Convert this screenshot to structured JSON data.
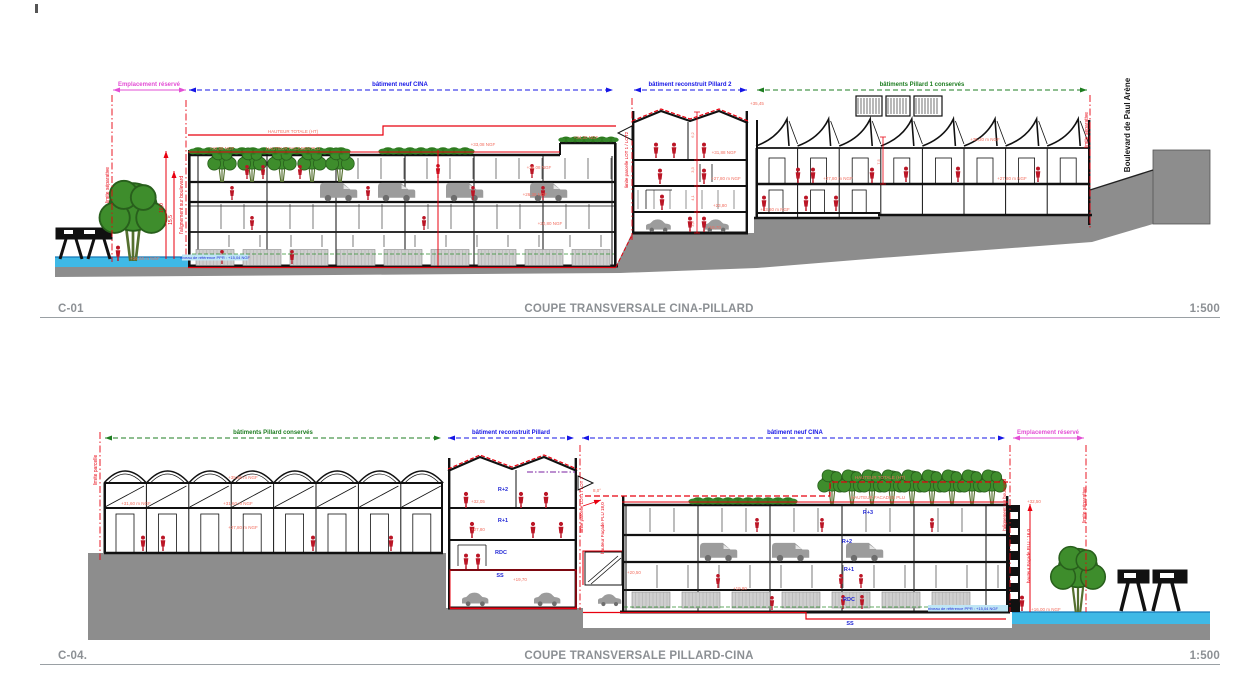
{
  "colors": {
    "red": "#e8000f",
    "pink": "#f26d5e",
    "magenta": "#e34fd5",
    "blue": "#1616e6",
    "blue2": "#2329d6",
    "green": "#1e7d21",
    "black": "#1a1a1a",
    "title_gray": "#8c9094",
    "ground": "#8d8d8d",
    "water": "#3fb9e6",
    "tree": "#3e8d2c",
    "people": "#bb1626",
    "vehicle": "#9c9c9c"
  },
  "titles": {
    "c01": {
      "ref": "C-01",
      "title": "COUPE TRANSVERSALE CINA-PILLARD",
      "scale": "1:500"
    },
    "c04": {
      "ref": "C-04.",
      "title": "COUPE TRANSVERSALE PILLARD-CINA",
      "scale": "1:500"
    }
  },
  "annotations": {
    "c01": [
      {
        "t": "Emplacement réservé",
        "x": 149,
        "y": 86,
        "c": "magenta",
        "s": 6,
        "b": 1,
        "n": "span-label-emplacement-reserve"
      },
      {
        "t": "bâtiment neuf CINA",
        "x": 400,
        "y": 86,
        "c": "blue",
        "s": 6,
        "b": 1,
        "n": "span-label-batiment-neuf-cina"
      },
      {
        "t": "bâtiment reconstruit Pillard 2",
        "x": 690,
        "y": 86,
        "c": "blue",
        "s": 6,
        "b": 1,
        "n": "span-label-batiment-reconstruit-pillard-2"
      },
      {
        "t": "bâtiments Pillard 1 conservés",
        "x": 922,
        "y": 86,
        "c": "green",
        "s": 6,
        "b": 1,
        "n": "span-label-batiments-pillard-1-conserves"
      },
      {
        "t": "limite séparative",
        "x": 109,
        "y": 185,
        "c": "red",
        "s": 5,
        "r": -90,
        "n": "boundary-label"
      },
      {
        "t": "l'alignement sur boulevard",
        "x": 183,
        "y": 205,
        "c": "red",
        "s": 5,
        "r": -90,
        "n": "boundary-label"
      },
      {
        "t": "limite parcelle LOT 1 / LOT2",
        "x": 628,
        "y": 160,
        "c": "red",
        "s": 4.5,
        "r": -90,
        "n": "boundary-label"
      },
      {
        "t": "limite séparative",
        "x": 1088,
        "y": 130,
        "c": "red",
        "s": 5,
        "r": -90,
        "n": "boundary-label"
      },
      {
        "t": "Boulevard de Paul Arène",
        "x": 1130,
        "y": 125,
        "c": "black",
        "s": 8,
        "r": -90,
        "b": 1,
        "n": "street-name"
      },
      {
        "t": "HAUTEUR TOTALE (HT)",
        "x": 293,
        "y": 133,
        "c": "pink",
        "s": 4.5
      },
      {
        "t": "HAUTEUR FACADES PLU",
        "x": 293,
        "y": 150,
        "c": "pink",
        "s": 4.5
      },
      {
        "t": "+32,88 NGF",
        "x": 222,
        "y": 150,
        "c": "pink",
        "s": 4.5
      },
      {
        "t": "+33,08 NGF",
        "x": 483,
        "y": 146,
        "c": "pink",
        "s": 4.5
      },
      {
        "t": "+34,30 NGF",
        "x": 586,
        "y": 139,
        "c": "pink",
        "s": 4.5
      },
      {
        "t": "+30,08 NGF",
        "x": 539,
        "y": 169,
        "c": "pink",
        "s": 4.5
      },
      {
        "t": "+26,38 NGF",
        "x": 535,
        "y": 196,
        "c": "pink",
        "s": 4.5
      },
      {
        "t": "+20,80 NGF",
        "x": 550,
        "y": 225,
        "c": "pink",
        "s": 4.5
      },
      {
        "t": "+35,45",
        "x": 757,
        "y": 105,
        "c": "pink",
        "s": 4.5
      },
      {
        "t": "+31,88 NGF",
        "x": 724,
        "y": 154,
        "c": "pink",
        "s": 4.5
      },
      {
        "t": "+27,80 m NGF",
        "x": 726,
        "y": 180,
        "c": "pink",
        "s": 4.5
      },
      {
        "t": "+23,80",
        "x": 720,
        "y": 207,
        "c": "pink",
        "s": 4.5
      },
      {
        "t": "+19,70",
        "x": 714,
        "y": 229,
        "c": "pink",
        "s": 4.5
      },
      {
        "t": "+35,30 m NGF",
        "x": 985,
        "y": 141,
        "c": "pink",
        "s": 4.5
      },
      {
        "t": "+27,80 m NGF",
        "x": 838,
        "y": 180,
        "c": "pink",
        "s": 4.5
      },
      {
        "t": "+27,80 m NGF",
        "x": 1012,
        "y": 180,
        "c": "pink",
        "s": 4.5
      },
      {
        "t": "+23,80 m NGF",
        "x": 775,
        "y": 211,
        "c": "pink",
        "s": 4.5
      },
      {
        "t": "niveau de référence PPR : +15,04 NGF",
        "x": 215,
        "y": 259,
        "c": "blue2",
        "s": 4
      },
      {
        "t": "+16,00 m NGF",
        "x": 145,
        "y": 260,
        "c": "pink",
        "s": 4.5
      },
      {
        "t": "18,0",
        "x": 163,
        "y": 208,
        "c": "red",
        "s": 5,
        "r": -90,
        "n": "dimension-label"
      },
      {
        "t": "15,5",
        "x": 172,
        "y": 220,
        "c": "red",
        "s": 5,
        "r": -90,
        "n": "dimension-label"
      },
      {
        "t": "6,2",
        "x": 694,
        "y": 135,
        "c": "pink",
        "s": 4,
        "r": -90,
        "n": "dimension-label"
      },
      {
        "t": "3,3",
        "x": 694,
        "y": 170,
        "c": "pink",
        "s": 4,
        "r": -90,
        "n": "dimension-label"
      },
      {
        "t": "4,1",
        "x": 694,
        "y": 198,
        "c": "pink",
        "s": 4,
        "r": -90,
        "n": "dimension-label"
      },
      {
        "t": "3,8",
        "x": 694,
        "y": 224,
        "c": "pink",
        "s": 4,
        "r": -90,
        "n": "dimension-label"
      },
      {
        "t": "7,5",
        "x": 880,
        "y": 162,
        "c": "pink",
        "s": 4,
        "r": -90,
        "n": "dimension-label"
      }
    ],
    "c04": [
      {
        "t": "bâtiments Pillard conservés",
        "x": 273,
        "y": 434,
        "c": "green",
        "s": 6,
        "b": 1,
        "n": "span-label-batiments-pillard-conserves"
      },
      {
        "t": "bâtiment reconstruit Pillard",
        "x": 511,
        "y": 434,
        "c": "blue",
        "s": 6,
        "b": 1,
        "n": "span-label-batiment-reconstruit-pillard"
      },
      {
        "t": "bâtiment neuf CINA",
        "x": 795,
        "y": 434,
        "c": "blue",
        "s": 6,
        "b": 1,
        "n": "span-label-batiment-neuf-cina"
      },
      {
        "t": "Emplacement réservé",
        "x": 1048,
        "y": 434,
        "c": "magenta",
        "s": 6,
        "b": 1,
        "n": "span-label-emplacement-reserve"
      },
      {
        "t": "limite parcelle",
        "x": 97,
        "y": 470,
        "c": "red",
        "s": 5,
        "r": -90,
        "n": "boundary-label"
      },
      {
        "t": "limite parcelle LOT1 / LOT 2",
        "x": 583,
        "y": 505,
        "c": "red",
        "s": 4.5,
        "r": -90,
        "n": "boundary-label"
      },
      {
        "t": "hauteur Façade PLU 18,0",
        "x": 604,
        "y": 528,
        "c": "red",
        "s": 4.5,
        "r": -90,
        "n": "dimension-label"
      },
      {
        "t": "l'alignement sur boulevard",
        "x": 1006,
        "y": 505,
        "c": "red",
        "s": 4.5,
        "r": -90,
        "n": "boundary-label"
      },
      {
        "t": "hauteur Façade PLU : 16,0",
        "x": 1030,
        "y": 556,
        "c": "red",
        "s": 4.5,
        "r": -90,
        "n": "dimension-label"
      },
      {
        "t": "limite séparative",
        "x": 1086,
        "y": 505,
        "c": "red",
        "s": 5,
        "r": -90,
        "n": "boundary-label"
      },
      {
        "t": "HAUTEUR TOTALE (HT)",
        "x": 880,
        "y": 479,
        "c": "pink",
        "s": 4.5
      },
      {
        "t": "HAUTEUR FACADES PLU",
        "x": 878,
        "y": 499,
        "c": "pink",
        "s": 4.5
      },
      {
        "t": "+35,66 m NGF",
        "x": 243,
        "y": 479,
        "c": "pink",
        "s": 4.5
      },
      {
        "t": "+31,60 m NGF",
        "x": 136,
        "y": 505,
        "c": "pink",
        "s": 4.5
      },
      {
        "t": "+31,60 m NGF",
        "x": 238,
        "y": 505,
        "c": "pink",
        "s": 4.5
      },
      {
        "t": "+27,80 m NGF",
        "x": 243,
        "y": 529,
        "c": "pink",
        "s": 4.5
      },
      {
        "t": "R+2",
        "x": 503,
        "y": 491,
        "c": "blue2",
        "s": 5.5,
        "b": 1,
        "n": "storey-label"
      },
      {
        "t": "R+1",
        "x": 503,
        "y": 522,
        "c": "blue2",
        "s": 5.5,
        "b": 1,
        "n": "storey-label"
      },
      {
        "t": "RDC",
        "x": 501,
        "y": 554,
        "c": "blue2",
        "s": 5.5,
        "b": 1,
        "n": "storey-label"
      },
      {
        "t": "SS",
        "x": 500,
        "y": 577,
        "c": "blue2",
        "s": 5.5,
        "b": 1,
        "n": "storey-label"
      },
      {
        "t": "+32,05",
        "x": 478,
        "y": 503,
        "c": "pink",
        "s": 4.5
      },
      {
        "t": "+27,80",
        "x": 478,
        "y": 531,
        "c": "pink",
        "s": 4.5
      },
      {
        "t": "+19,70",
        "x": 520,
        "y": 581,
        "c": "pink",
        "s": 4.5
      },
      {
        "t": "8,0°",
        "x": 597,
        "y": 492,
        "c": "pink",
        "s": 4.5
      },
      {
        "t": "R+3",
        "x": 868,
        "y": 514,
        "c": "blue2",
        "s": 5.5,
        "b": 1,
        "n": "storey-label"
      },
      {
        "t": "R+2",
        "x": 847,
        "y": 543,
        "c": "blue2",
        "s": 5.5,
        "b": 1,
        "n": "storey-label"
      },
      {
        "t": "R+1",
        "x": 849,
        "y": 571,
        "c": "blue2",
        "s": 5.5,
        "b": 1,
        "n": "storey-label"
      },
      {
        "t": "RDC",
        "x": 849,
        "y": 601,
        "c": "blue2",
        "s": 5.5,
        "b": 1,
        "n": "storey-label"
      },
      {
        "t": "SS",
        "x": 850,
        "y": 625,
        "c": "blue2",
        "s": 5.5,
        "b": 1,
        "n": "storey-label"
      },
      {
        "t": "+32,50",
        "x": 1034,
        "y": 503,
        "c": "pink",
        "s": 4.5
      },
      {
        "t": "+20,50",
        "x": 634,
        "y": 574,
        "c": "pink",
        "s": 4.5
      },
      {
        "t": "+19,80",
        "x": 740,
        "y": 590,
        "c": "pink",
        "s": 4.5
      },
      {
        "t": "niveau de référence PPR : +15,04 NGF",
        "x": 963,
        "y": 610,
        "c": "blue2",
        "s": 4
      },
      {
        "t": "+16,00 m NGF",
        "x": 1046,
        "y": 611,
        "c": "pink",
        "s": 4.5
      }
    ]
  }
}
